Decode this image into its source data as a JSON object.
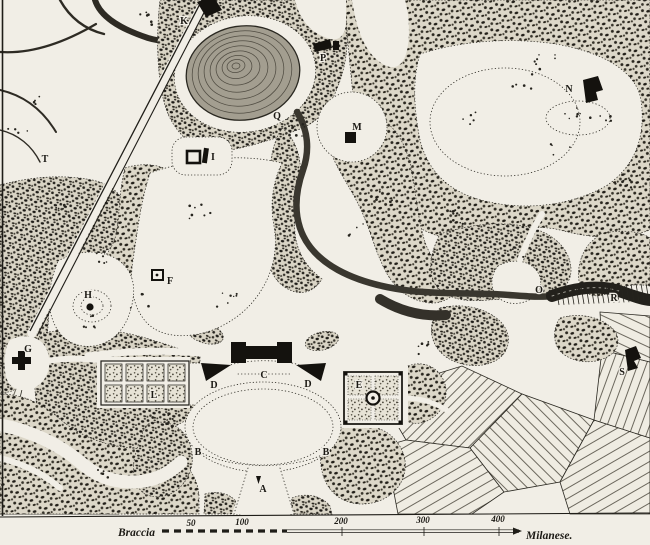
{
  "map": {
    "description": "engraved-landscape-garden-plan",
    "letters": [
      {
        "t": "K"
      },
      {
        "t": "T"
      },
      {
        "t": "P"
      },
      {
        "t": "Q"
      },
      {
        "t": "M"
      },
      {
        "t": "I"
      },
      {
        "t": "N"
      },
      {
        "t": "F"
      },
      {
        "t": "H"
      },
      {
        "t": "G"
      },
      {
        "t": "O"
      },
      {
        "t": "R"
      },
      {
        "t": "S"
      },
      {
        "t": "C"
      },
      {
        "t": "D"
      },
      {
        "t": "D"
      },
      {
        "t": "L"
      },
      {
        "t": "E"
      },
      {
        "t": "B"
      },
      {
        "t": "B"
      },
      {
        "t": "A"
      }
    ],
    "scale_bar": {
      "unit_left": "Braccia",
      "unit_right": "Milanese.",
      "ticks": [
        {
          "t": "50"
        },
        {
          "t": "100"
        },
        {
          "t": "200"
        },
        {
          "t": "300"
        },
        {
          "t": "400"
        }
      ]
    },
    "colors": {
      "paper": "#f1eee6",
      "ink": "#1f1d18",
      "water": "#38352d"
    }
  }
}
